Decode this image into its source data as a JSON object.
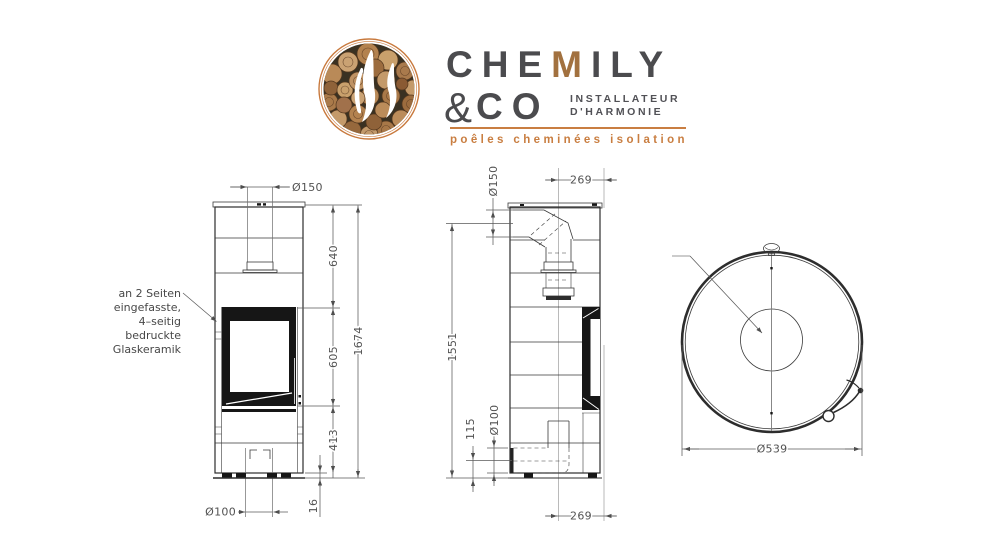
{
  "logo": {
    "icon": "wood-logs-flame-badge",
    "brand": {
      "pre": "CHE",
      "wood": "M",
      "post": "ILY",
      "amp": "&",
      "co": "CO"
    },
    "tagline1": "INSTALLATEUR",
    "tagline2": "D'HARMONIE",
    "subtitle": "poêles cheminées isolation",
    "colors": {
      "accent": "#c97e41",
      "text": "#4b4b4e",
      "wood": "#a2713f"
    }
  },
  "annotation": {
    "lines": [
      "an 2 Seiten",
      "eingefasste,",
      "4–seitig",
      "bedruckte",
      "Glaskeramik"
    ]
  },
  "views": {
    "front": {
      "dims": {
        "flue_diameter": "Ø150",
        "upper_height": "640",
        "door_height": "605",
        "base_height": "413",
        "total_height": "1674",
        "plinth_height": "16",
        "air_inlet_diameter": "Ø100"
      }
    },
    "side": {
      "dims": {
        "flue_diameter": "Ø150",
        "flue_front_offset": "269",
        "flue_center_height": "1551",
        "air_inlet_center_height": "115",
        "air_inlet_diameter": "Ø100",
        "air_front_offset": "269"
      }
    },
    "top": {
      "dims": {
        "body_diameter": "Ø539"
      }
    }
  }
}
